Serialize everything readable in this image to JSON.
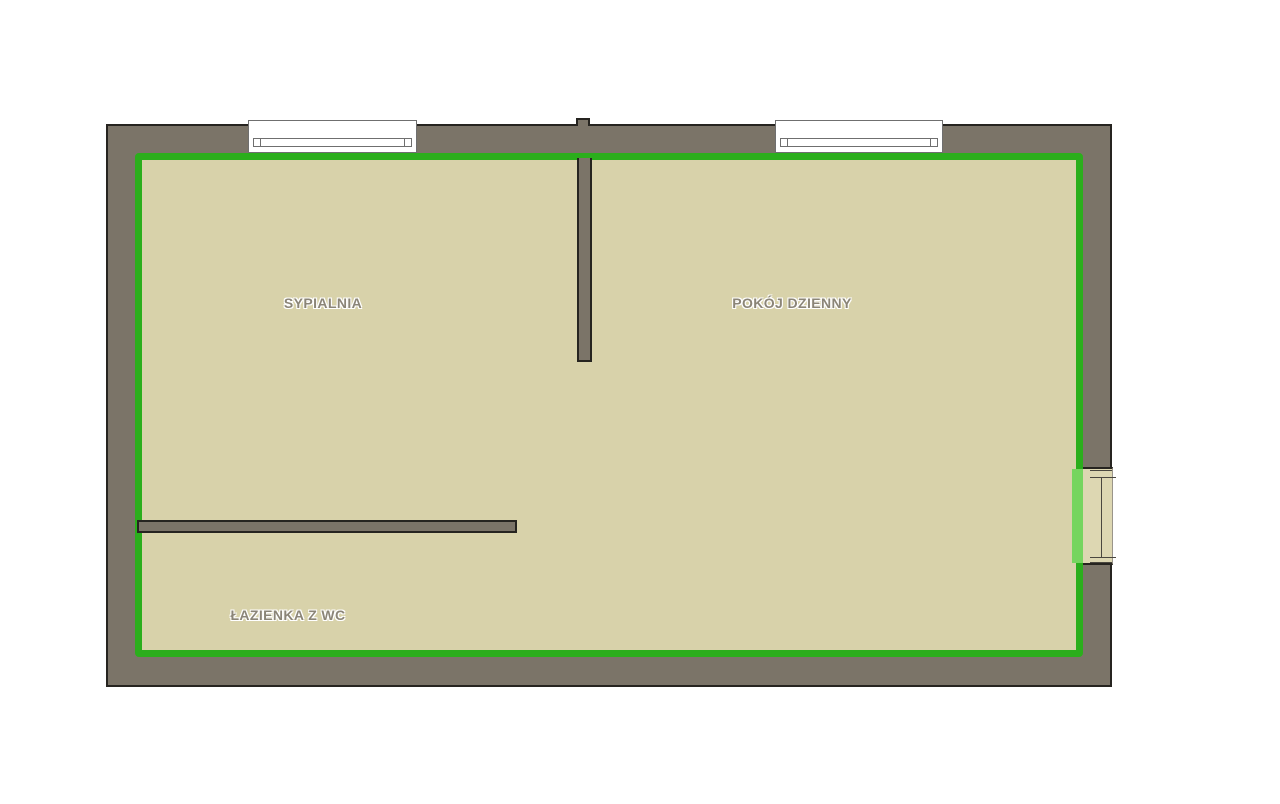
{
  "floor_plan": {
    "rooms": [
      {
        "name": "sypialnia",
        "label": "SYPIALNIA"
      },
      {
        "name": "pokoj-dzienny",
        "label": "POKÓJ DZIENNY"
      },
      {
        "name": "lazienka-z-wc",
        "label": "ŁAZIENKA Z WC"
      }
    ],
    "features": {
      "windows": [
        "window-top-left",
        "window-top-right"
      ],
      "doors": [
        "door-right-wall"
      ],
      "partitions": [
        "partition-bedroom-living",
        "partition-bathroom"
      ]
    },
    "colors": {
      "background": "#ffffff",
      "wall_fill": "#7b7468",
      "wall_outline": "#262420",
      "floor": "#d8d2aa",
      "room_outline_green": "#2bae1c",
      "door_highlight_green": "#76d55f",
      "window_fill": "#ffffff",
      "window_line": "#6f6f6f",
      "label_text": "#8b8577"
    }
  }
}
